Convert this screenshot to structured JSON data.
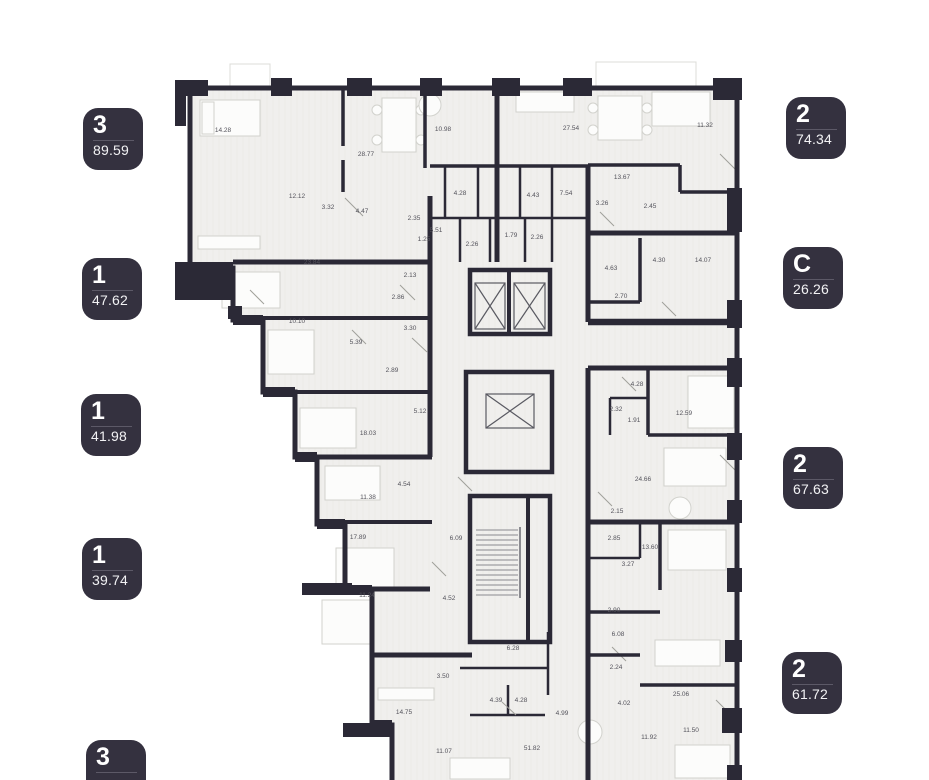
{
  "palette": {
    "wall": "#2b2936",
    "badge_bg": "#34313f",
    "badge_divider": "#5c5967",
    "room_fill": "#f0efed",
    "label_color": "#54535b",
    "background": "#ffffff"
  },
  "badges": {
    "left": [
      {
        "type": "3",
        "area": "89.59",
        "x": 83,
        "y": 108
      },
      {
        "type": "1",
        "area": "47.62",
        "x": 82,
        "y": 258
      },
      {
        "type": "1",
        "area": "41.98",
        "x": 81,
        "y": 394
      },
      {
        "type": "1",
        "area": "39.74",
        "x": 82,
        "y": 538
      },
      {
        "type": "3",
        "area": "",
        "x": 86,
        "y": 740
      }
    ],
    "right": [
      {
        "type": "2",
        "area": "74.34",
        "x": 786,
        "y": 97
      },
      {
        "type": "C",
        "area": "26.26",
        "x": 783,
        "y": 247
      },
      {
        "type": "2",
        "area": "67.63",
        "x": 783,
        "y": 447
      },
      {
        "type": "2",
        "area": "61.72",
        "x": 782,
        "y": 652
      }
    ]
  },
  "plan": {
    "rooms": [
      {
        "label": "14.28",
        "x": 223,
        "y": 132
      },
      {
        "label": "28.77",
        "x": 366,
        "y": 156
      },
      {
        "label": "10.98",
        "x": 443,
        "y": 131
      },
      {
        "label": "12.12",
        "x": 297,
        "y": 198
      },
      {
        "label": "3.32",
        "x": 328,
        "y": 209
      },
      {
        "label": "4.47",
        "x": 362,
        "y": 213
      },
      {
        "label": "2.35",
        "x": 414,
        "y": 220
      },
      {
        "label": "5.51",
        "x": 436,
        "y": 232
      },
      {
        "label": "1.25",
        "x": 424,
        "y": 241
      },
      {
        "label": "4.28",
        "x": 460,
        "y": 195
      },
      {
        "label": "2.26",
        "x": 472,
        "y": 246
      },
      {
        "label": "1.79",
        "x": 511,
        "y": 237
      },
      {
        "label": "2.26",
        "x": 537,
        "y": 239
      },
      {
        "label": "27.54",
        "x": 571,
        "y": 130
      },
      {
        "label": "11.32",
        "x": 705,
        "y": 127
      },
      {
        "label": "13.67",
        "x": 622,
        "y": 179
      },
      {
        "label": "4.43",
        "x": 533,
        "y": 197
      },
      {
        "label": "7.54",
        "x": 566,
        "y": 195
      },
      {
        "label": "3.26",
        "x": 602,
        "y": 205
      },
      {
        "label": "2.45",
        "x": 650,
        "y": 208
      },
      {
        "label": "4.63",
        "x": 611,
        "y": 270
      },
      {
        "label": "4.30",
        "x": 659,
        "y": 262
      },
      {
        "label": "14.07",
        "x": 703,
        "y": 262
      },
      {
        "label": "2.70",
        "x": 621,
        "y": 298
      },
      {
        "label": "23.84",
        "x": 312,
        "y": 264
      },
      {
        "label": "2.13",
        "x": 410,
        "y": 277
      },
      {
        "label": "2.86",
        "x": 398,
        "y": 299
      },
      {
        "label": "10.10",
        "x": 297,
        "y": 323
      },
      {
        "label": "5.39",
        "x": 356,
        "y": 344
      },
      {
        "label": "3.30",
        "x": 410,
        "y": 330
      },
      {
        "label": "2.89",
        "x": 392,
        "y": 372
      },
      {
        "label": "5.12",
        "x": 420,
        "y": 413
      },
      {
        "label": "18.03",
        "x": 368,
        "y": 435
      },
      {
        "label": "4.28",
        "x": 637,
        "y": 386
      },
      {
        "label": "2.32",
        "x": 616,
        "y": 411
      },
      {
        "label": "1.91",
        "x": 634,
        "y": 422
      },
      {
        "label": "12.59",
        "x": 684,
        "y": 415
      },
      {
        "label": "24.66",
        "x": 643,
        "y": 481
      },
      {
        "label": "2.15",
        "x": 617,
        "y": 513
      },
      {
        "label": "11.38",
        "x": 368,
        "y": 499
      },
      {
        "label": "4.54",
        "x": 404,
        "y": 486
      },
      {
        "label": "17.89",
        "x": 358,
        "y": 539
      },
      {
        "label": "6.09",
        "x": 456,
        "y": 540
      },
      {
        "label": "11.24",
        "x": 367,
        "y": 597
      },
      {
        "label": "4.52",
        "x": 449,
        "y": 600
      },
      {
        "label": "2.85",
        "x": 614,
        "y": 540
      },
      {
        "label": "13.60",
        "x": 650,
        "y": 549
      },
      {
        "label": "3.27",
        "x": 628,
        "y": 566
      },
      {
        "label": "2.90",
        "x": 614,
        "y": 612
      },
      {
        "label": "6.08",
        "x": 618,
        "y": 636
      },
      {
        "label": "2.24",
        "x": 616,
        "y": 669
      },
      {
        "label": "4.02",
        "x": 624,
        "y": 705
      },
      {
        "label": "25.06",
        "x": 681,
        "y": 696
      },
      {
        "label": "11.92",
        "x": 649,
        "y": 739
      },
      {
        "label": "11.50",
        "x": 691,
        "y": 732
      },
      {
        "label": "6.28",
        "x": 513,
        "y": 650
      },
      {
        "label": "3.50",
        "x": 443,
        "y": 678
      },
      {
        "label": "4.39",
        "x": 496,
        "y": 702
      },
      {
        "label": "4.28",
        "x": 521,
        "y": 702
      },
      {
        "label": "4.99",
        "x": 562,
        "y": 715
      },
      {
        "label": "14.75",
        "x": 404,
        "y": 714
      },
      {
        "label": "11.07",
        "x": 444,
        "y": 753
      },
      {
        "label": "51.82",
        "x": 532,
        "y": 750
      }
    ]
  }
}
